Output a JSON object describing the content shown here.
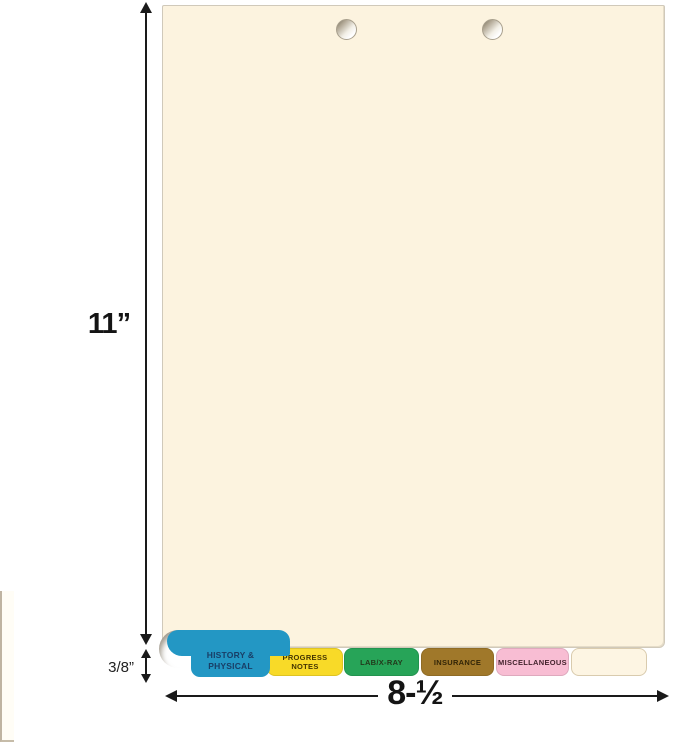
{
  "dimensions": {
    "height_label": "11”",
    "width_label": "8-½",
    "tab_depth_label": "3/8”"
  },
  "tabs": [
    {
      "label": "HISTORY & PHYSICAL",
      "bg": "#2397c4",
      "text": "#193e66"
    },
    {
      "label": "PROGRESS NOTES",
      "bg": "#f8da28",
      "text": "#443501"
    },
    {
      "label": "LAB/X-RAY",
      "bg": "#27a458",
      "text": "#22391b"
    },
    {
      "label": "INSURANCE",
      "bg": "#a0782a",
      "text": "#322507"
    },
    {
      "label": "MISCELLANEOUS",
      "bg": "#f8bdd3",
      "text": "#44242e"
    },
    {
      "label": "",
      "bg": "#fdf5e3",
      "text": "#5a4a2a",
      "border_color": "#d9cbae"
    }
  ],
  "colors": {
    "paper": "#fcf3df",
    "paper_border": "#d0c9ba",
    "arrow": "#1a1a1a"
  }
}
